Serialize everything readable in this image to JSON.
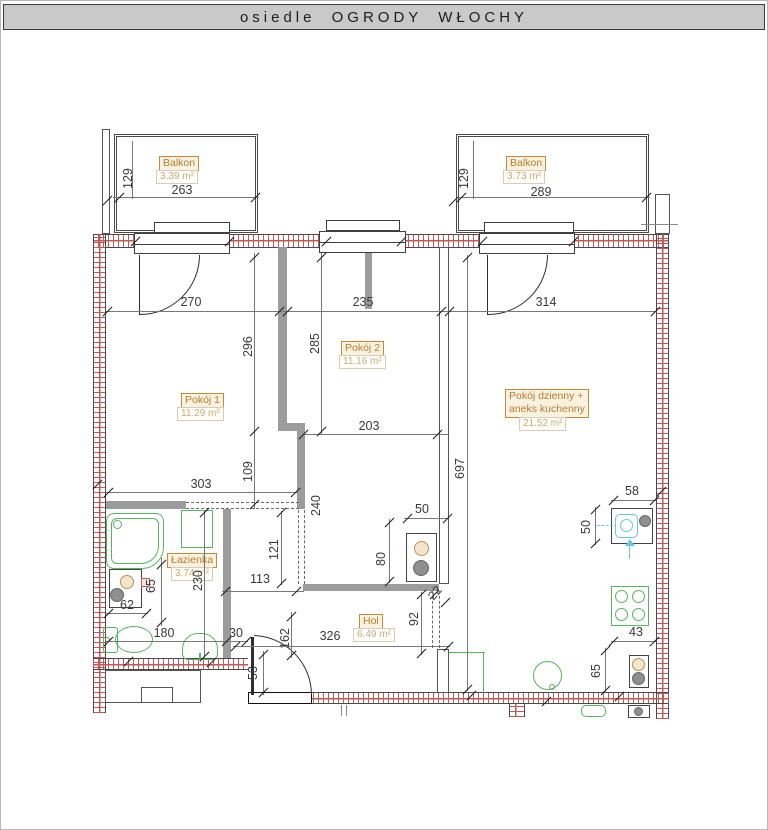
{
  "header": {
    "title": "osiedle OGRODY WŁOCHY"
  },
  "rooms": {
    "balkon_left": {
      "name": "Balkon",
      "area": "3.39 m²"
    },
    "balkon_right": {
      "name": "Balkon",
      "area": "3.73 m²"
    },
    "pokoj1": {
      "name": "Pokój 1",
      "area": "11.29 m²"
    },
    "pokoj2": {
      "name": "Pokój 2",
      "area": "11.16 m²"
    },
    "living": {
      "name_line1": "Pokój dzienny +",
      "name_line2": "aneks kuchenny",
      "area": "21.52 m²"
    },
    "lazienka": {
      "name": "Łazienka",
      "area": "3.74 m²"
    },
    "hol": {
      "name": "Hol",
      "area": "6.49 m²"
    }
  },
  "dimensions": {
    "balkon_left_width": "263",
    "balkon_left_depth": "129",
    "balkon_right_width": "289",
    "balkon_right_depth": "129",
    "pokoj1_width": "270",
    "pokoj2_width": "235",
    "living_width": "314",
    "pokoj1_height": "296",
    "pokoj2_height": "285",
    "living_height": "697",
    "pokoj2_lower_width": "203",
    "pokoj1_lower_height": "109",
    "pokoj1_lower_width": "303",
    "corridor_height": "240",
    "wardrobe_height": "121",
    "corridor_width": "113",
    "bathroom_height": "230",
    "basin_zone_height": "65",
    "basin_width": "62",
    "bathroom_width": "180",
    "nook_width": "30",
    "entry_offset": "162",
    "hol_width": "326",
    "entry_door_width": "53",
    "hol_nook_height": "92",
    "wall_stub": "22",
    "washer_nook_height": "80",
    "washer_nook_width": "50",
    "sink_width": "58",
    "sink_depth": "50",
    "stove_gap": "43",
    "fridge_width": "65"
  },
  "colors": {
    "wall_hatch": "#c25858",
    "fixture_green": "#58b460",
    "label_orange": "#b57d2a",
    "sink_cyan": "#6ec6dc",
    "header_bg": "#c9c9c9"
  }
}
